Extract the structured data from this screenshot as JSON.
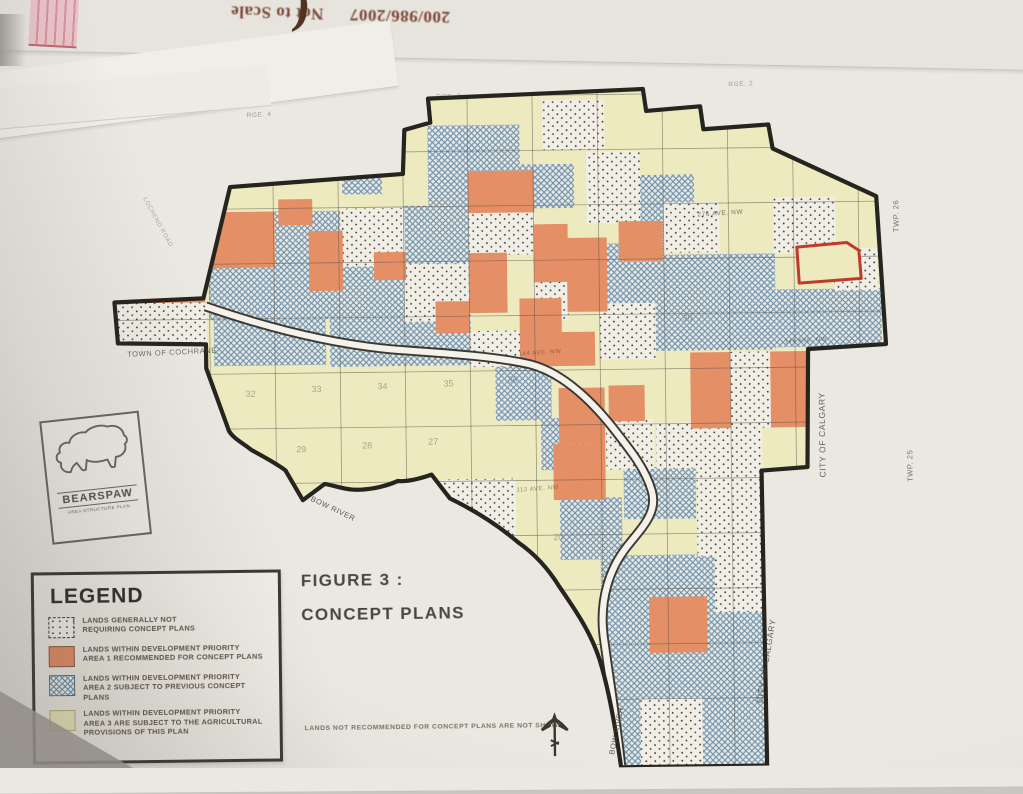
{
  "photo": {
    "flipped_header": {
      "digits": "200/986/2007",
      "text": "Not to Scale",
      "paren": "("
    }
  },
  "figure": {
    "line1": "FIGURE 3 :",
    "line2": "CONCEPT PLANS"
  },
  "logo": {
    "name": "BEARSPAW",
    "subtitle": "AREA STRUCTURE PLAN"
  },
  "note": "LANDS NOT RECOMMENDED FOR CONCEPT PLANS ARE NOT SHOWN",
  "legend": {
    "title": "LEGEND",
    "items": [
      {
        "swatch": "dots",
        "text": "LANDS GENERALLY NOT\nREQUIRING CONCEPT PLANS"
      },
      {
        "swatch": "orange",
        "text": "LANDS WITHIN DEVELOPMENT PRIORITY\nAREA 1 RECOMMENDED FOR CONCEPT PLANS"
      },
      {
        "swatch": "hatch",
        "text": "LANDS WITHIN DEVELOPMENT PRIORITY\nAREA 2 SUBJECT TO PREVIOUS CONCEPT PLANS"
      },
      {
        "swatch": "yellow",
        "text": "LANDS WITHIN DEVELOPMENT PRIORITY\nAREA 3 ARE SUBJECT TO THE AGRICULTURAL\nPROVISIONS OF THIS PLAN"
      }
    ]
  },
  "map": {
    "colors": {
      "yellow": "#eeeabf",
      "orange": "#e58f66",
      "hatch": "#6d8fac",
      "hatch_bg": "#e6e8e1",
      "dot": "#3a3832",
      "dot_bg": "#f1eee5",
      "boundary": "#26241e",
      "grid": "#57524a",
      "riverbank": "#3a3832",
      "riverfill": "#f4f2ea",
      "red": "#c03a2b"
    },
    "labels": [
      {
        "text": "TOWN OF COCHRANE",
        "x": 172,
        "y": 350,
        "r": -2,
        "s": 7.5,
        "o": 0.75
      },
      {
        "text": "CITY OF CALGARY",
        "x": 824,
        "y": 438,
        "r": -90,
        "s": 8.5,
        "o": 0.8
      },
      {
        "text": "CITY OF CALGARY",
        "x": 765,
        "y": 664,
        "r": -80,
        "s": 8.5,
        "o": 0.8
      },
      {
        "text": "TWP. 26",
        "x": 900,
        "y": 220,
        "r": -90,
        "s": 7.5,
        "o": 0.7
      },
      {
        "text": "TWP. 25",
        "x": 911,
        "y": 470,
        "r": -90,
        "s": 7.5,
        "o": 0.7
      },
      {
        "text": "BOW RIVER",
        "x": 330,
        "y": 508,
        "r": 26,
        "s": 7.5,
        "o": 0.85
      },
      {
        "text": "BOW RIVER",
        "x": 614,
        "y": 732,
        "r": -78,
        "s": 7.5,
        "o": 0.85
      },
      {
        "text": "276 AVE. NW",
        "x": 722,
        "y": 217,
        "r": -3,
        "s": 6.5,
        "o": 0.7
      },
      {
        "text": "LOCHEND ROAD",
        "x": 158,
        "y": 218,
        "r": 62,
        "s": 6,
        "o": 0.4
      },
      {
        "text": "144 AVE. NW",
        "x": 806,
        "y": 345,
        "r": -3,
        "s": 6,
        "o": 0.6
      },
      {
        "text": "144 AVE. NW",
        "x": 540,
        "y": 354,
        "r": -3,
        "s": 6,
        "o": 0.55
      },
      {
        "text": "112 AVE. NW",
        "x": 536,
        "y": 490,
        "r": -3,
        "s": 6,
        "o": 0.55
      },
      {
        "text": "RGE. 4",
        "x": 262,
        "y": 113,
        "r": -2,
        "s": 6.5,
        "o": 0.45
      },
      {
        "text": "RGE. 3",
        "x": 452,
        "y": 97,
        "r": -2,
        "s": 6.5,
        "o": 0.45
      },
      {
        "text": "RGE. 2",
        "x": 744,
        "y": 88,
        "r": -2,
        "s": 6.5,
        "o": 0.45
      }
    ],
    "numbers": [
      {
        "n": "32",
        "x": 250,
        "y": 393
      },
      {
        "n": "33",
        "x": 316,
        "y": 389
      },
      {
        "n": "34",
        "x": 382,
        "y": 387
      },
      {
        "n": "35",
        "x": 448,
        "y": 385
      },
      {
        "n": "36",
        "x": 512,
        "y": 382
      },
      {
        "n": "29",
        "x": 300,
        "y": 449
      },
      {
        "n": "28",
        "x": 366,
        "y": 446
      },
      {
        "n": "27",
        "x": 432,
        "y": 443
      },
      {
        "n": "20",
        "x": 556,
        "y": 540
      },
      {
        "n": "30",
        "x": 688,
        "y": 322
      }
    ],
    "cells": [
      {
        "t": "h",
        "x": 276,
        "y": 208,
        "w": 66,
        "h": 108
      },
      {
        "t": "h",
        "x": 342,
        "y": 262,
        "w": 64,
        "h": 56
      },
      {
        "t": "h",
        "x": 405,
        "y": 204,
        "w": 66,
        "h": 60
      },
      {
        "t": "h",
        "x": 430,
        "y": 124,
        "w": 92,
        "h": 80
      },
      {
        "t": "h",
        "x": 520,
        "y": 164,
        "w": 56,
        "h": 44
      },
      {
        "t": "h",
        "x": 600,
        "y": 244,
        "w": 66,
        "h": 60
      },
      {
        "t": "h",
        "x": 640,
        "y": 176,
        "w": 56,
        "h": 72
      },
      {
        "t": "h",
        "x": 656,
        "y": 256,
        "w": 120,
        "h": 96
      },
      {
        "t": "h",
        "x": 776,
        "y": 292,
        "w": 106,
        "h": 58
      },
      {
        "t": "h",
        "x": 210,
        "y": 262,
        "w": 68,
        "h": 54
      },
      {
        "t": "h",
        "x": 214,
        "y": 300,
        "w": 112,
        "h": 62
      },
      {
        "t": "h",
        "x": 330,
        "y": 312,
        "w": 76,
        "h": 52
      },
      {
        "t": "h",
        "x": 405,
        "y": 318,
        "w": 66,
        "h": 46
      },
      {
        "t": "h",
        "x": 495,
        "y": 362,
        "w": 56,
        "h": 58
      },
      {
        "t": "h",
        "x": 540,
        "y": 418,
        "w": 62,
        "h": 52
      },
      {
        "t": "h",
        "x": 622,
        "y": 468,
        "w": 72,
        "h": 52
      },
      {
        "t": "h",
        "x": 558,
        "y": 498,
        "w": 62,
        "h": 62
      },
      {
        "t": "h",
        "x": 598,
        "y": 556,
        "w": 164,
        "h": 214
      },
      {
        "t": "h",
        "x": 344,
        "y": 168,
        "w": 40,
        "h": 24
      },
      {
        "t": "d",
        "x": 115,
        "y": 294,
        "w": 92,
        "h": 46
      },
      {
        "t": "d",
        "x": 342,
        "y": 206,
        "w": 64,
        "h": 58
      },
      {
        "t": "d",
        "x": 470,
        "y": 210,
        "w": 66,
        "h": 44
      },
      {
        "t": "d",
        "x": 405,
        "y": 262,
        "w": 66,
        "h": 58
      },
      {
        "t": "d",
        "x": 535,
        "y": 260,
        "w": 34,
        "h": 60
      },
      {
        "t": "d",
        "x": 545,
        "y": 100,
        "w": 62,
        "h": 50
      },
      {
        "t": "d",
        "x": 588,
        "y": 152,
        "w": 54,
        "h": 72
      },
      {
        "t": "d",
        "x": 600,
        "y": 304,
        "w": 56,
        "h": 56
      },
      {
        "t": "d",
        "x": 665,
        "y": 204,
        "w": 56,
        "h": 50
      },
      {
        "t": "d",
        "x": 775,
        "y": 200,
        "w": 62,
        "h": 56
      },
      {
        "t": "d",
        "x": 835,
        "y": 252,
        "w": 44,
        "h": 42
      },
      {
        "t": "d",
        "x": 470,
        "y": 330,
        "w": 64,
        "h": 36
      },
      {
        "t": "d",
        "x": 730,
        "y": 354,
        "w": 42,
        "h": 76
      },
      {
        "t": "d",
        "x": 655,
        "y": 424,
        "w": 106,
        "h": 46
      },
      {
        "t": "d",
        "x": 605,
        "y": 420,
        "w": 48,
        "h": 50
      },
      {
        "t": "d",
        "x": 695,
        "y": 468,
        "w": 64,
        "h": 90
      },
      {
        "t": "d",
        "x": 712,
        "y": 556,
        "w": 48,
        "h": 58
      },
      {
        "t": "d",
        "x": 636,
        "y": 700,
        "w": 62,
        "h": 66
      },
      {
        "t": "d",
        "x": 440,
        "y": 478,
        "w": 74,
        "h": 62
      },
      {
        "t": "o",
        "x": 210,
        "y": 208,
        "w": 66,
        "h": 56
      },
      {
        "t": "o",
        "x": 148,
        "y": 248,
        "w": 58,
        "h": 50
      },
      {
        "t": "o",
        "x": 310,
        "y": 228,
        "w": 34,
        "h": 60
      },
      {
        "t": "o",
        "x": 470,
        "y": 170,
        "w": 66,
        "h": 42
      },
      {
        "t": "o",
        "x": 535,
        "y": 224,
        "w": 34,
        "h": 58
      },
      {
        "t": "o",
        "x": 568,
        "y": 238,
        "w": 40,
        "h": 74
      },
      {
        "t": "o",
        "x": 620,
        "y": 222,
        "w": 44,
        "h": 40
      },
      {
        "t": "o",
        "x": 470,
        "y": 252,
        "w": 38,
        "h": 60
      },
      {
        "t": "o",
        "x": 520,
        "y": 298,
        "w": 42,
        "h": 66
      },
      {
        "t": "o",
        "x": 535,
        "y": 332,
        "w": 60,
        "h": 34
      },
      {
        "t": "o",
        "x": 436,
        "y": 300,
        "w": 34,
        "h": 32
      },
      {
        "t": "o",
        "x": 690,
        "y": 354,
        "w": 40,
        "h": 76
      },
      {
        "t": "o",
        "x": 770,
        "y": 354,
        "w": 38,
        "h": 76
      },
      {
        "t": "o",
        "x": 558,
        "y": 388,
        "w": 46,
        "h": 56
      },
      {
        "t": "o",
        "x": 608,
        "y": 386,
        "w": 36,
        "h": 36
      },
      {
        "t": "o",
        "x": 552,
        "y": 444,
        "w": 52,
        "h": 56
      },
      {
        "t": "o",
        "x": 646,
        "y": 598,
        "w": 58,
        "h": 56
      },
      {
        "t": "o",
        "x": 280,
        "y": 196,
        "w": 34,
        "h": 26
      },
      {
        "t": "o",
        "x": 375,
        "y": 250,
        "w": 32,
        "h": 28
      }
    ],
    "red_parcel_points": "798,250 848,246 860,254 862,282 800,286"
  }
}
